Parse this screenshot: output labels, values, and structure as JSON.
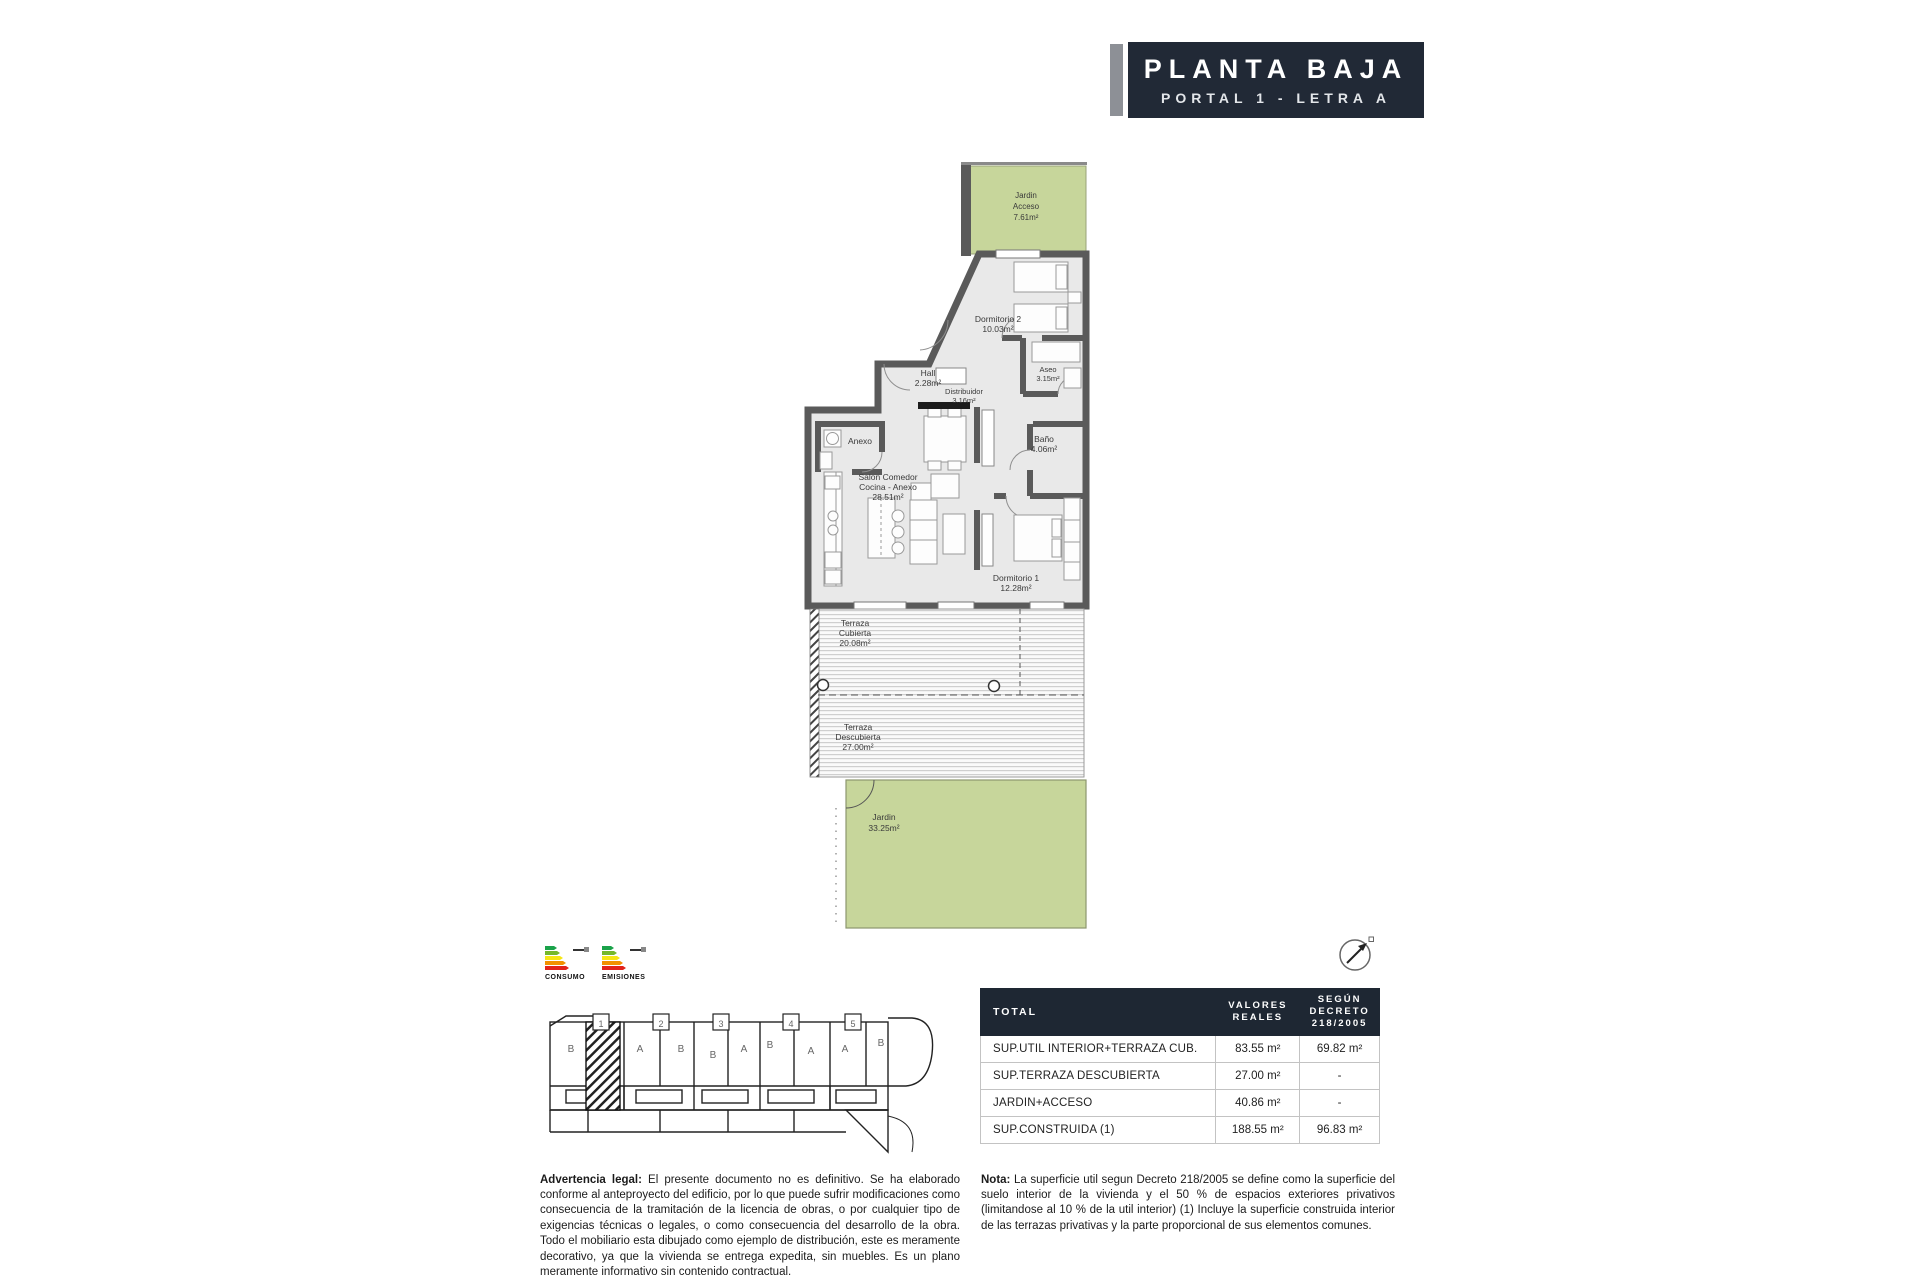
{
  "title_block": {
    "line1": "PLANTA BAJA",
    "line2": "PORTAL 1 - LETRA A",
    "bg": "#212936",
    "accent": "#8d9096"
  },
  "plan": {
    "colors": {
      "wall": "#5a5a5a",
      "floor": "#e9e9e9",
      "garden": "#c7d69b"
    },
    "rooms": {
      "jardin_acceso": {
        "l1": "Jardin",
        "l2": "Acceso",
        "l3": "7.61m²"
      },
      "dormitorio2": {
        "l1": "Dormitorio 2",
        "l2": "10.03m²"
      },
      "aseo": {
        "l1": "Aseo",
        "l2": "3.15m²"
      },
      "hall": {
        "l1": "Hall",
        "l2": "2.28m²"
      },
      "distribuidor": {
        "l1": "Distribuidor",
        "l2": "3.16m²"
      },
      "anexo": {
        "l1": "Anexo"
      },
      "salon": {
        "l1": "Salon Comedor",
        "l2": "Cocina - Anexo",
        "l3": "28.51m²"
      },
      "bano": {
        "l1": "Baño",
        "l2": "4.06m²"
      },
      "dormitorio1": {
        "l1": "Dormitorio 1",
        "l2": "12.28m²"
      },
      "terraza_cubierta": {
        "l1": "Terraza",
        "l2": "Cubierta",
        "l3": "20.08m²"
      },
      "terraza_descubierta": {
        "l1": "Terraza",
        "l2": "Descubierta",
        "l3": "27.00m²"
      },
      "jardin": {
        "l1": "Jardin",
        "l2": "33.25m²"
      }
    }
  },
  "energy": {
    "consumo_label": "CONSUMO",
    "emisiones_label": "EMISIONES"
  },
  "siteplan": {
    "portals": [
      "1",
      "2",
      "3",
      "4",
      "5"
    ],
    "units": [
      "B",
      "A",
      "B",
      "B",
      "A",
      "B",
      "A",
      "A",
      "B"
    ]
  },
  "table": {
    "header": {
      "col1": "TOTAL",
      "col2_l1": "VALORES",
      "col2_l2": "REALES",
      "col3_l1": "SEGÚN",
      "col3_l2": "DECRETO",
      "col3_l3": "218/2005"
    },
    "rows": [
      {
        "label": "SUP.UTIL INTERIOR+TERRAZA CUB.",
        "real": "83.55 m²",
        "decreto": "69.82 m²"
      },
      {
        "label": "SUP.TERRAZA DESCUBIERTA",
        "real": "27.00 m²",
        "decreto": "-"
      },
      {
        "label": "JARDIN+ACCESO",
        "real": "40.86 m²",
        "decreto": "-"
      },
      {
        "label": "SUP.CONSTRUIDA (1)",
        "real": "188.55 m²",
        "decreto": "96.83 m²"
      }
    ]
  },
  "legal": {
    "lead": "Advertencia legal:",
    "body": " El presente documento no es definitivo. Se ha elaborado conforme al anteproyecto del edificio, por lo que puede sufrir modificaciones como consecuencia de la tramitación de la licencia de obras, o por cualquier tipo de exigencias técnicas o legales, o como consecuencia del desarrollo de la obra. Todo el mobiliario esta dibujado como ejemplo de distribución, este es meramente decorativo, ya que la vivienda se entrega expedita, sin muebles. Es un plano meramente informativo sin contenido contractual."
  },
  "note": {
    "lead": "Nota:",
    "body": " La superficie util segun Decreto 218/2005 se define como la superficie del suelo interior de la vivienda y el 50 % de espacios exteriores privativos (limitandose al 10 % de la util interior) (1) Incluye la superficie construida interior de las terrazas privativas y la parte proporcional de sus elementos comunes."
  }
}
